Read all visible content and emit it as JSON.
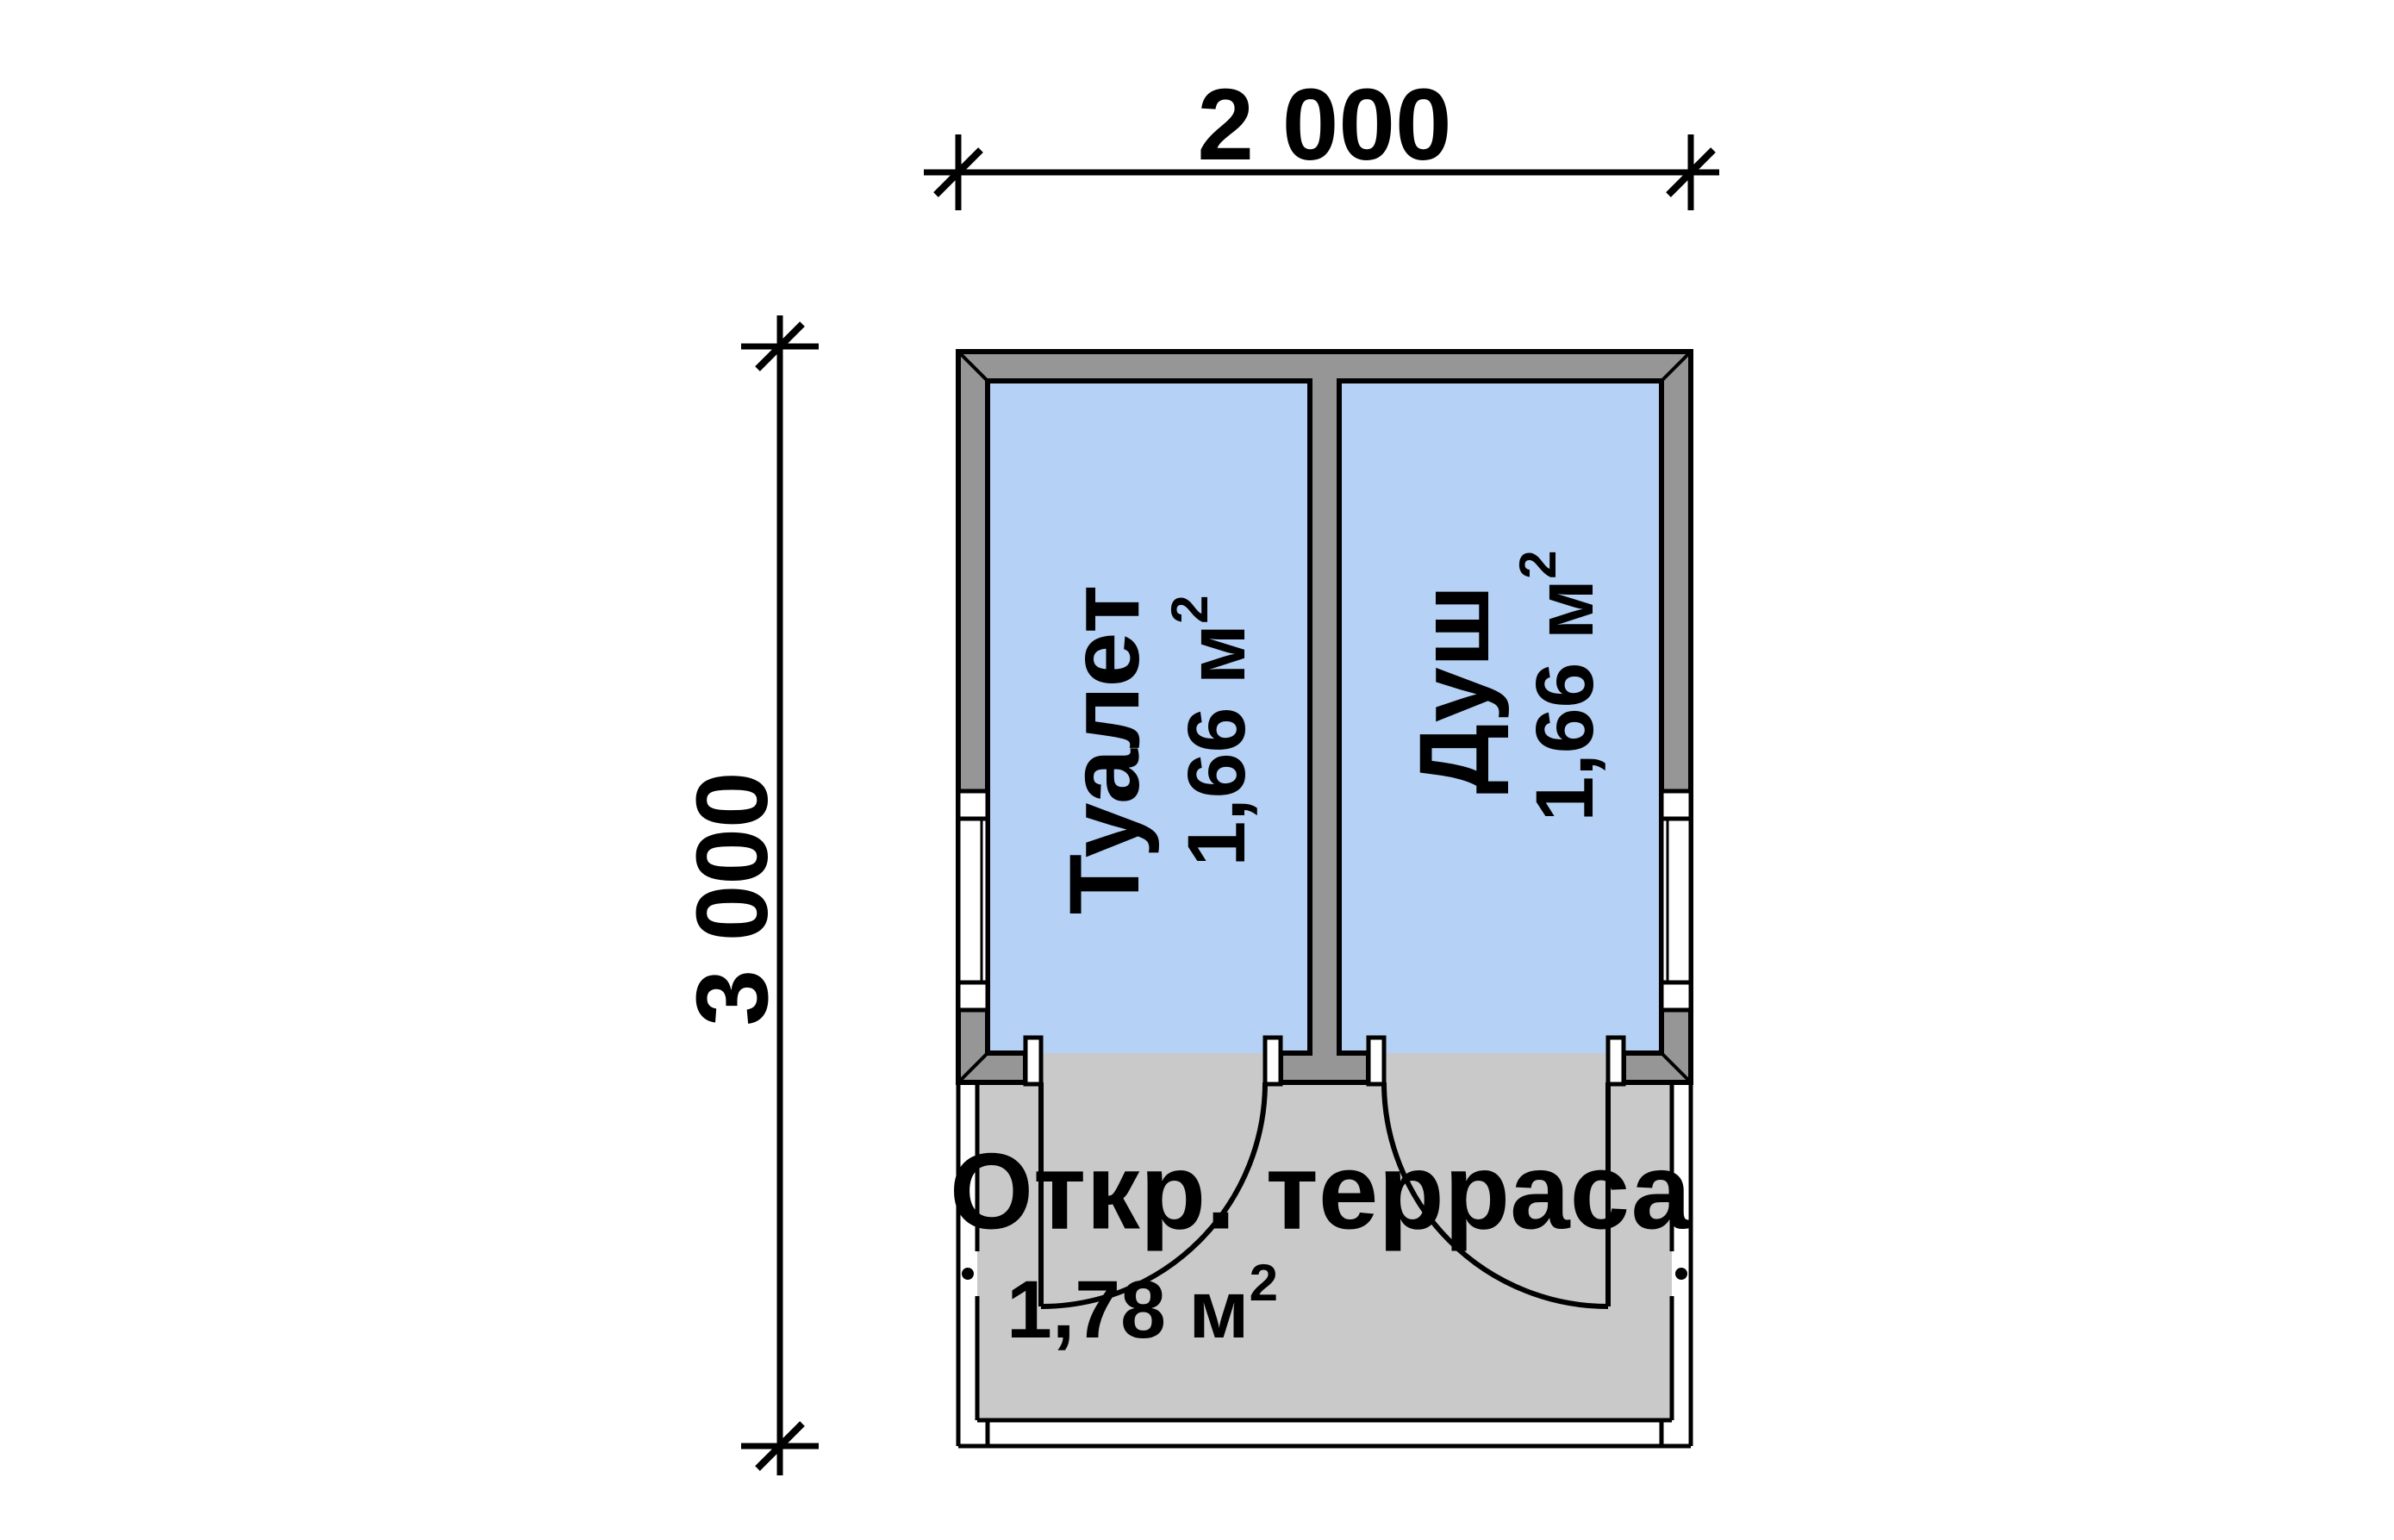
{
  "dimensions": {
    "width_label": "2 000",
    "height_label": "3 000"
  },
  "rooms": [
    {
      "name": "Туалет",
      "area": "1,66 м",
      "area_superscript": "2"
    },
    {
      "name": "Душ",
      "area": "1,66 м",
      "area_superscript": "2"
    }
  ],
  "terrace": {
    "name": "Откр. терраса",
    "area": "1,78 м",
    "area_superscript": "2"
  },
  "colors": {
    "background": "#ffffff",
    "room_fill": "#b5d1f5",
    "wall_fill": "#969696",
    "terrace_fill": "#c9c9c9",
    "line": "#000000"
  }
}
